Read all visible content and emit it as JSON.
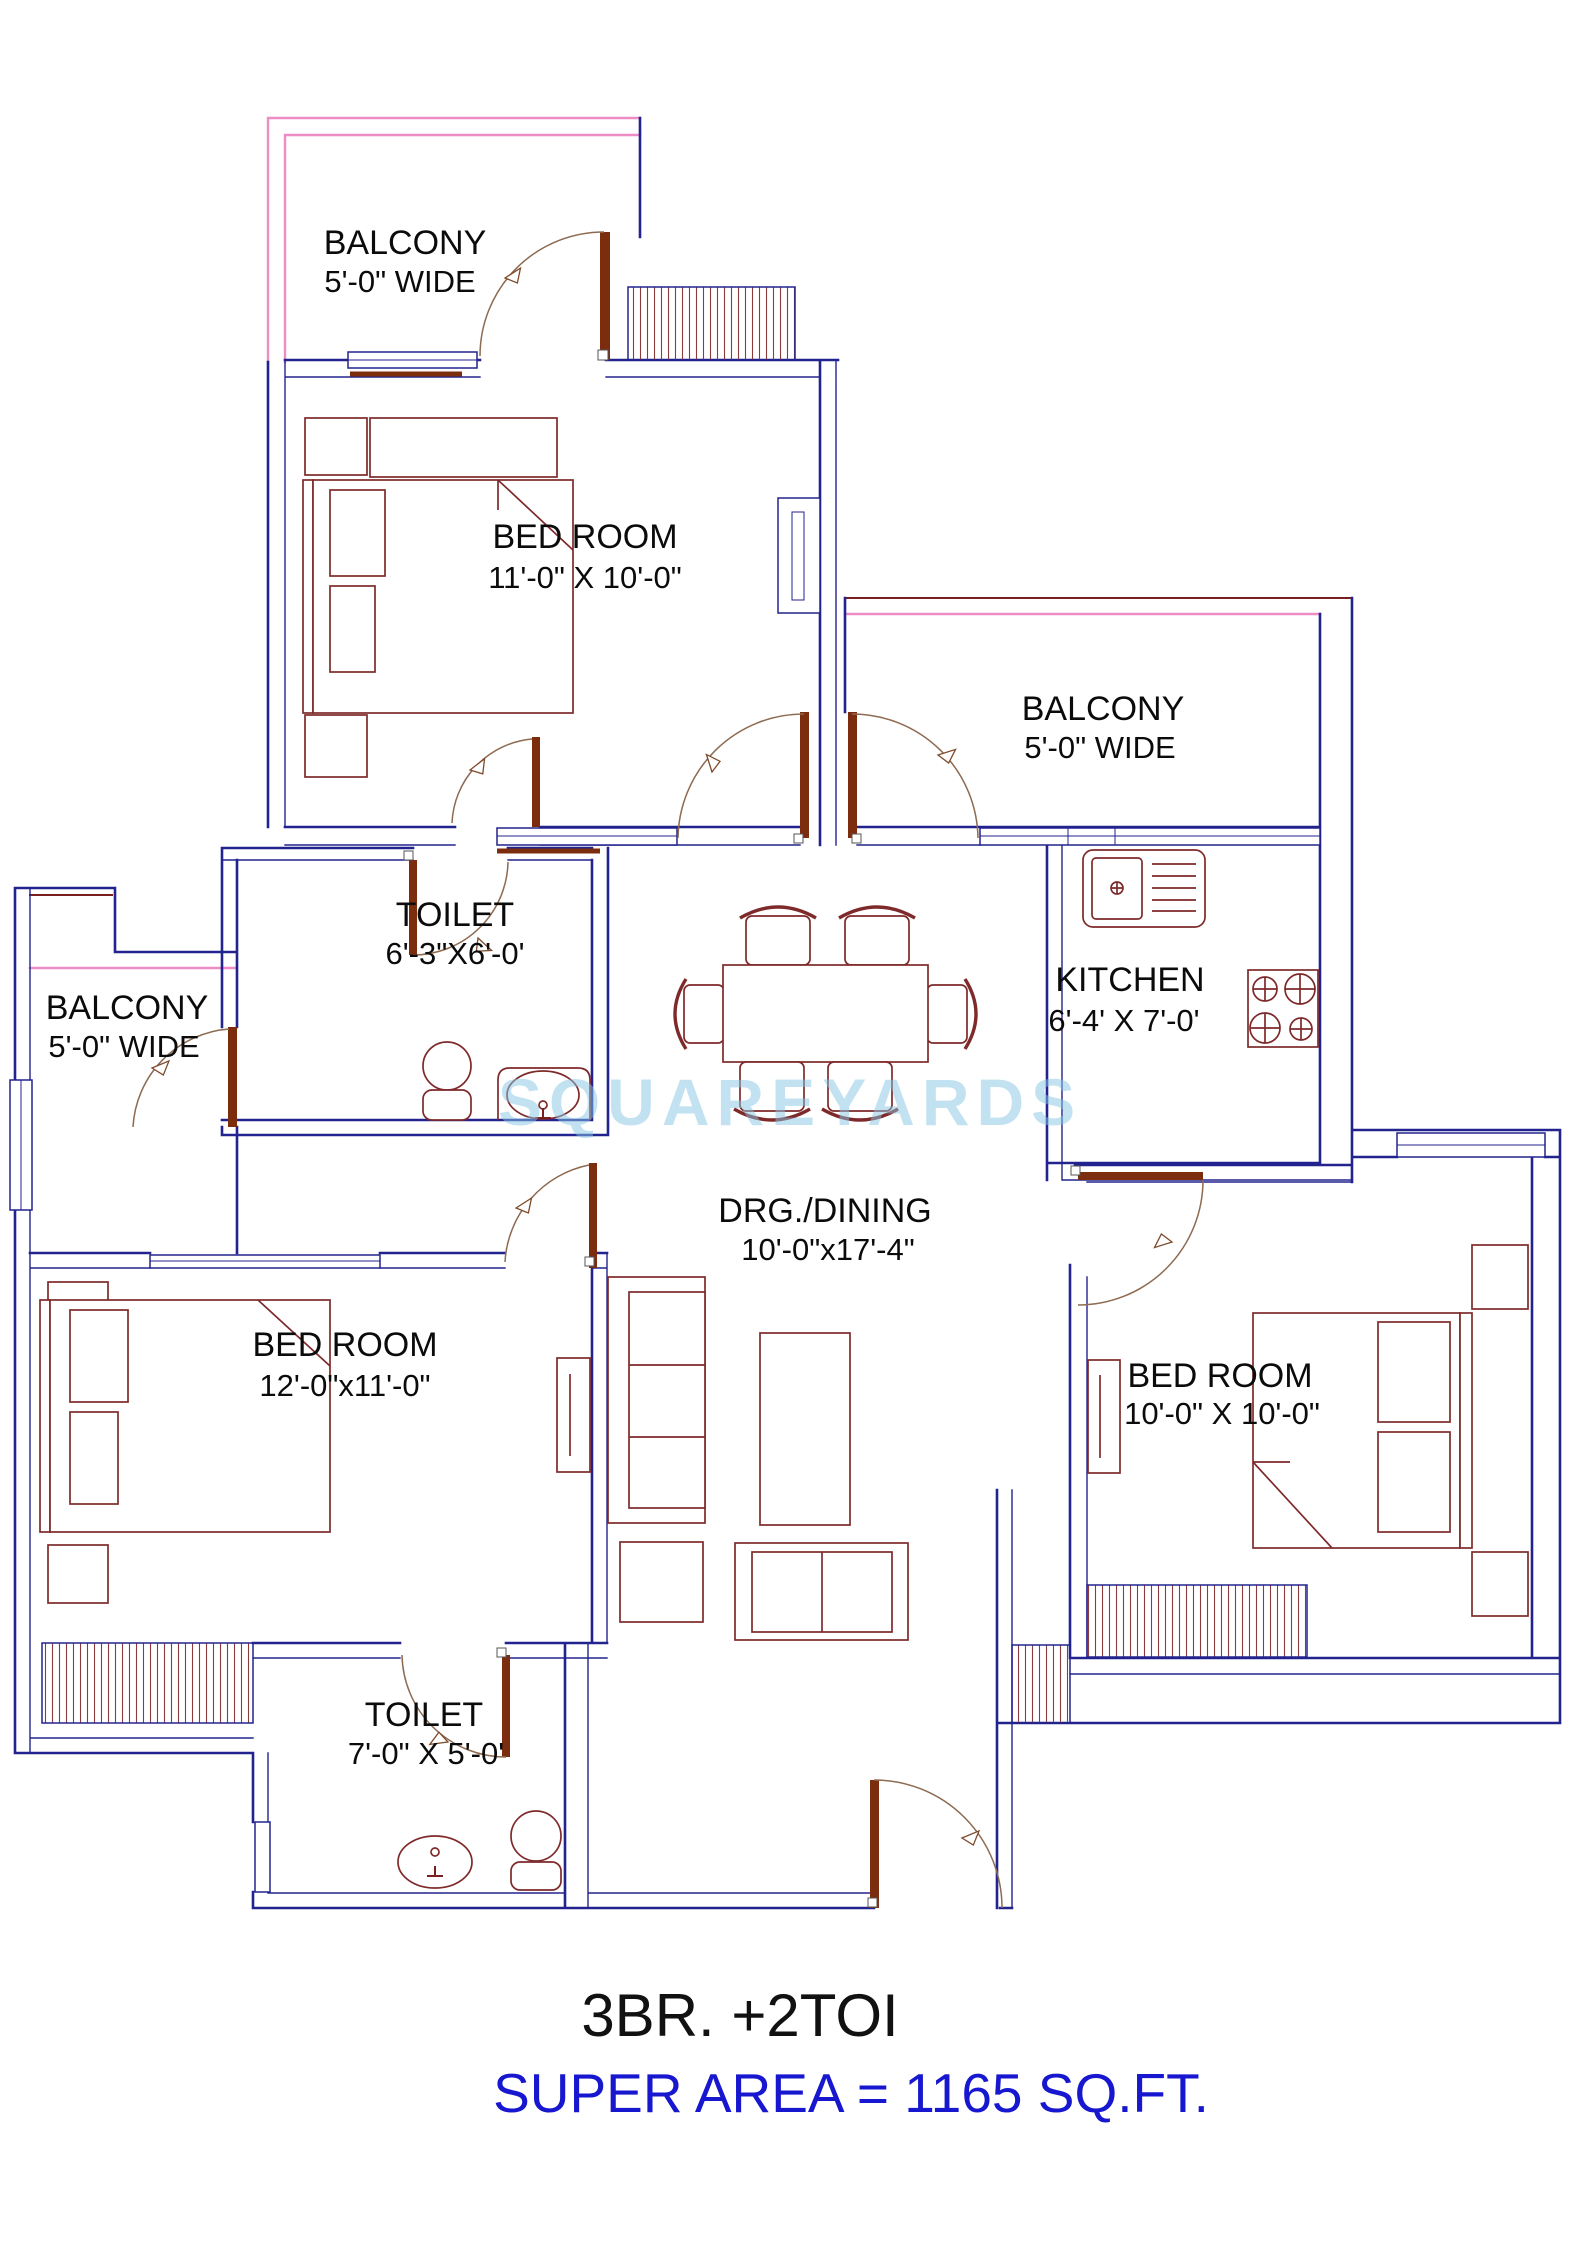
{
  "plan": {
    "type": "apartment-floor-plan",
    "watermark": {
      "text": "SQUAREYARDS"
    },
    "rooms": {
      "balcony_tl": {
        "name": "BALCONY",
        "dim": "5'-0\" WIDE"
      },
      "bedroom_top": {
        "name": "BED ROOM",
        "dim": "11'-0\" X 10'-0\""
      },
      "balcony_right": {
        "name": "BALCONY",
        "dim": "5'-0\" WIDE"
      },
      "toilet_mid": {
        "name": "TOILET",
        "dim": "6'-3\"X6'-0'"
      },
      "kitchen": {
        "name": "KITCHEN",
        "dim": "6'-4' X 7'-0'"
      },
      "balcony_left": {
        "name": "BALCONY",
        "dim": "5'-0\" WIDE"
      },
      "drg_dining": {
        "name": "DRG./DINING",
        "dim": "10'-0\"x17'-4\""
      },
      "bedroom_left": {
        "name": "BED ROOM",
        "dim": "12'-0\"x11'-0\""
      },
      "bedroom_right": {
        "name": "BED ROOM",
        "dim": "10'-0\" X 10'-0\""
      },
      "toilet_bottom": {
        "name": "TOILET",
        "dim": "7'-0\" X 5'-0'"
      }
    },
    "footer": {
      "title": "3BR. +2TOI",
      "super_area": "SUPER AREA  = 1165 SQ.FT."
    },
    "colors": {
      "wall_blue": "#23238f",
      "balcony_pink": "#ee8cc6",
      "furniture_maroon": "#7e2a2a",
      "door_brown": "#7c2d0e",
      "footer_blue": "#1717cf",
      "watermark_blue": "#86c6e4",
      "text_black": "#0b0b0b"
    }
  }
}
